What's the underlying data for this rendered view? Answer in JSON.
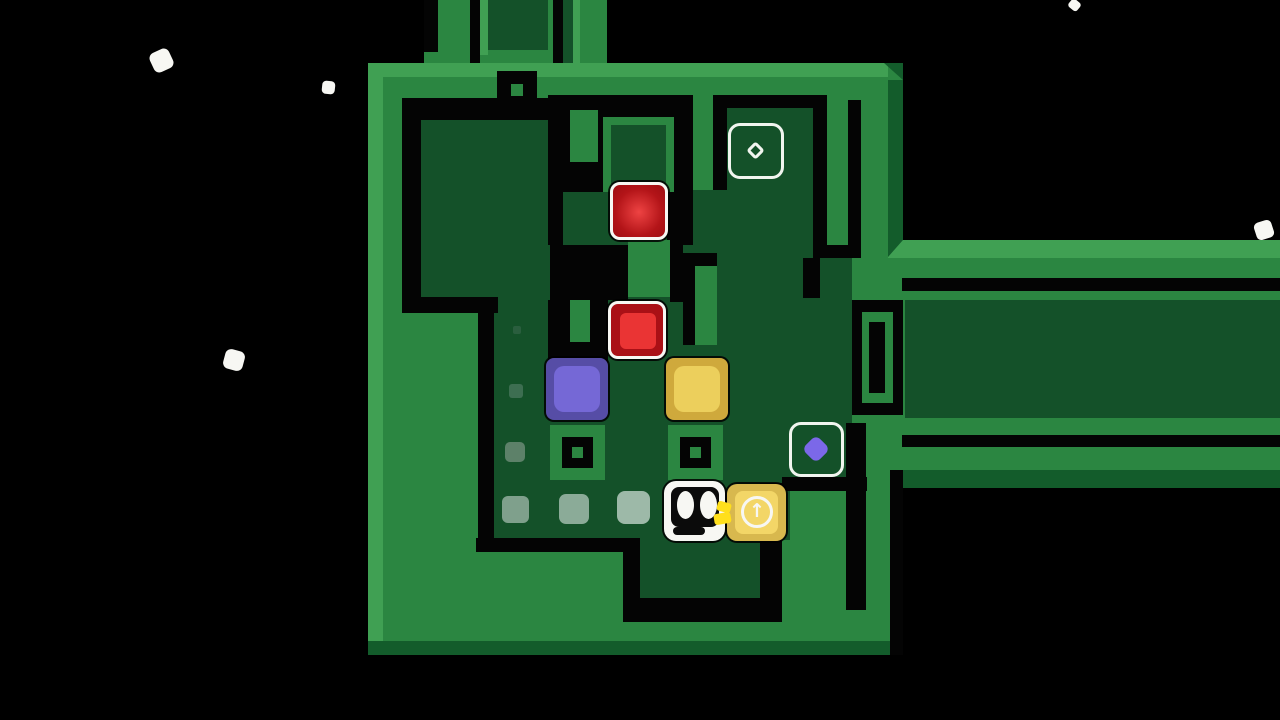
{
  "meta": {
    "scene": "tile-puzzle game level",
    "arrow_glyph": "↑"
  },
  "colors": {
    "black": "#040404",
    "green": "#2b8641",
    "light": "#40a053",
    "dark": "#135c2b",
    "floor": "#145129",
    "white": "#f7f7f3",
    "redOuter": "#aa1016",
    "redInner": "#ea3434",
    "purpleOuter": "#564da6",
    "purpleInner": "#7568d6",
    "yellowOuter": "#cfa93c",
    "yellowInner": "#eccf5c",
    "goldOuter": "#d8b84e",
    "goldInner": "#f3d667",
    "hand": "#ffdf1c",
    "targetStroke": "#f1f5ef",
    "diamondPurple": "#7b68e8",
    "none": "transparent"
  },
  "scene": [
    {
      "n": "star-particle",
      "x": 151,
      "y": 50,
      "w": 21,
      "h": 21,
      "f": "white",
      "r": 6,
      "rot": -25
    },
    {
      "n": "star-particle",
      "x": 322,
      "y": 81,
      "w": 13,
      "h": 13,
      "f": "white",
      "r": 4,
      "rot": 6
    },
    {
      "n": "star-particle",
      "x": 1069,
      "y": 0,
      "w": 11,
      "h": 10,
      "f": "white",
      "r": 3,
      "rot": 40
    },
    {
      "n": "star-particle",
      "x": 1255,
      "y": 221,
      "w": 18,
      "h": 18,
      "f": "white",
      "r": 5,
      "rot": -18
    },
    {
      "n": "star-particle",
      "x": 224,
      "y": 350,
      "w": 20,
      "h": 20,
      "f": "white",
      "r": 6,
      "rot": 15
    },
    {
      "n": "platform-column-left",
      "x": 424,
      "y": 0,
      "w": 46,
      "h": 63,
      "f": "green"
    },
    {
      "n": "wall-groove",
      "x": 424,
      "y": 0,
      "w": 14,
      "h": 52,
      "f": "black"
    },
    {
      "n": "wall-groove",
      "x": 470,
      "y": 0,
      "w": 10,
      "h": 63,
      "f": "black"
    },
    {
      "n": "platform-column-wide",
      "x": 480,
      "y": 0,
      "w": 76,
      "h": 63,
      "f": "green"
    },
    {
      "n": "bevel-light",
      "x": 480,
      "y": 0,
      "w": 8,
      "h": 55,
      "f": "light"
    },
    {
      "n": "floor-inset-top",
      "x": 488,
      "y": 0,
      "w": 60,
      "h": 50,
      "f": "floor"
    },
    {
      "n": "wall-groove",
      "x": 553,
      "y": 0,
      "w": 10,
      "h": 101,
      "f": "black"
    },
    {
      "n": "floor-corridor-top",
      "x": 563,
      "y": 0,
      "w": 10,
      "h": 97,
      "f": "floor"
    },
    {
      "n": "platform-column-mid",
      "x": 573,
      "y": 0,
      "w": 34,
      "h": 63,
      "f": "green"
    },
    {
      "n": "bevel-light",
      "x": 573,
      "y": 0,
      "w": 7,
      "h": 63,
      "f": "light"
    },
    {
      "n": "platform-main",
      "x": 368,
      "y": 63,
      "w": 535,
      "h": 592,
      "f": "green"
    },
    {
      "n": "platform-arm-upper",
      "x": 890,
      "y": 240,
      "w": 390,
      "h": 60,
      "f": "green"
    },
    {
      "n": "platform-arm-lower",
      "x": 890,
      "y": 418,
      "w": 390,
      "h": 52,
      "f": "green"
    },
    {
      "n": "platform-corridor-lip",
      "x": 888,
      "y": 300,
      "w": 18,
      "h": 118,
      "f": "green"
    },
    {
      "n": "bevel-light-top",
      "x": 368,
      "y": 63,
      "w": 520,
      "h": 14,
      "f": "light"
    },
    {
      "n": "bevel-light-left",
      "x": 368,
      "y": 63,
      "w": 15,
      "h": 578,
      "f": "light"
    },
    {
      "n": "bevel-corner",
      "x": 884,
      "y": 63,
      "w": 19,
      "h": 17,
      "f": "dark",
      "clip": "tr"
    },
    {
      "n": "bevel-dark-right",
      "x": 888,
      "y": 80,
      "w": 15,
      "h": 160,
      "f": "dark"
    },
    {
      "n": "bevel-light-arm",
      "x": 888,
      "y": 240,
      "w": 392,
      "h": 18,
      "f": "light"
    },
    {
      "n": "bevel-corner",
      "x": 888,
      "y": 240,
      "w": 15,
      "h": 17,
      "f": "dark",
      "clip": "tl"
    },
    {
      "n": "bevel-dark-bottom",
      "x": 382,
      "y": 641,
      "w": 508,
      "h": 14,
      "f": "dark"
    },
    {
      "n": "bevel-corner",
      "x": 368,
      "y": 641,
      "w": 15,
      "h": 14,
      "f": "dark"
    },
    {
      "n": "bevel-dark-armbottom",
      "x": 897,
      "y": 470,
      "w": 383,
      "h": 18,
      "f": "dark"
    },
    {
      "n": "void-patch",
      "x": 890,
      "y": 470,
      "w": 13,
      "h": 185,
      "f": "black"
    },
    {
      "n": "floor-upper-left",
      "x": 421,
      "y": 120,
      "w": 129,
      "h": 177,
      "f": "floor"
    },
    {
      "n": "floor-red-row",
      "x": 563,
      "y": 192,
      "w": 119,
      "h": 53,
      "f": "floor"
    },
    {
      "n": "floor-central",
      "x": 628,
      "y": 258,
      "w": 162,
      "h": 42,
      "f": "floor"
    },
    {
      "n": "floor-main",
      "x": 490,
      "y": 297,
      "w": 300,
      "h": 243,
      "f": "floor"
    },
    {
      "n": "floor-corridor-mid",
      "x": 682,
      "y": 190,
      "w": 131,
      "h": 110,
      "f": "floor"
    },
    {
      "n": "floor-target-cell",
      "x": 727,
      "y": 107,
      "w": 86,
      "h": 83,
      "f": "floor"
    },
    {
      "n": "floor-right",
      "x": 790,
      "y": 258,
      "w": 62,
      "h": 225,
      "f": "floor"
    },
    {
      "n": "floor-below-player",
      "x": 640,
      "y": 480,
      "w": 120,
      "h": 120,
      "f": "floor"
    },
    {
      "n": "floor-right-corridor",
      "x": 905,
      "y": 300,
      "w": 375,
      "h": 118,
      "f": "floor"
    },
    {
      "n": "wall-groove",
      "x": 402,
      "y": 98,
      "w": 158,
      "h": 22,
      "f": "black"
    },
    {
      "n": "wall-groove",
      "x": 402,
      "y": 98,
      "w": 19,
      "h": 215,
      "f": "black"
    },
    {
      "n": "wall-groove",
      "x": 402,
      "y": 297,
      "w": 96,
      "h": 16,
      "f": "black"
    },
    {
      "n": "wall-groove",
      "x": 478,
      "y": 297,
      "w": 16,
      "h": 255,
      "f": "black"
    },
    {
      "n": "wall-groove",
      "x": 476,
      "y": 538,
      "w": 164,
      "h": 14,
      "f": "black"
    },
    {
      "n": "wall-groove",
      "x": 623,
      "y": 538,
      "w": 17,
      "h": 84,
      "f": "black"
    },
    {
      "n": "wall-groove",
      "x": 640,
      "y": 598,
      "w": 142,
      "h": 24,
      "f": "black"
    },
    {
      "n": "wall-groove",
      "x": 760,
      "y": 483,
      "w": 22,
      "h": 127,
      "f": "black"
    },
    {
      "n": "wall-groove",
      "x": 846,
      "y": 423,
      "w": 20,
      "h": 187,
      "f": "black"
    },
    {
      "n": "wall-band-top",
      "x": 548,
      "y": 95,
      "w": 145,
      "h": 22,
      "f": "black"
    },
    {
      "n": "wall-block",
      "x": 548,
      "y": 117,
      "w": 59,
      "h": 75,
      "f": "black"
    },
    {
      "n": "wall-stub-green",
      "x": 570,
      "y": 110,
      "w": 28,
      "h": 52,
      "f": "green"
    },
    {
      "n": "wall-groove",
      "x": 667,
      "y": 95,
      "w": 26,
      "h": 150,
      "f": "black"
    },
    {
      "n": "wall-groove",
      "x": 713,
      "y": 95,
      "w": 114,
      "h": 13,
      "f": "black"
    },
    {
      "n": "wall-groove",
      "x": 713,
      "y": 95,
      "w": 14,
      "h": 95,
      "f": "black"
    },
    {
      "n": "wall-groove",
      "x": 813,
      "y": 100,
      "w": 14,
      "h": 145,
      "f": "black"
    },
    {
      "n": "wall-groove",
      "x": 848,
      "y": 100,
      "w": 13,
      "h": 158,
      "f": "black"
    },
    {
      "n": "wall-groove",
      "x": 813,
      "y": 245,
      "w": 48,
      "h": 13,
      "f": "black"
    },
    {
      "n": "wall-groove",
      "x": 803,
      "y": 258,
      "w": 17,
      "h": 40,
      "f": "black"
    },
    {
      "n": "wall-groove",
      "x": 548,
      "y": 192,
      "w": 15,
      "h": 53,
      "f": "black"
    },
    {
      "n": "wall-block",
      "x": 550,
      "y": 245,
      "w": 78,
      "h": 55,
      "f": "black"
    },
    {
      "n": "wall-island-green",
      "x": 628,
      "y": 240,
      "w": 42,
      "h": 57,
      "f": "green"
    },
    {
      "n": "wall-groove",
      "x": 670,
      "y": 240,
      "w": 13,
      "h": 62,
      "f": "black"
    },
    {
      "n": "wall-hook-black",
      "x": 683,
      "y": 253,
      "w": 34,
      "h": 92,
      "f": "black"
    },
    {
      "n": "wall-hook-green",
      "x": 695,
      "y": 266,
      "w": 22,
      "h": 79,
      "f": "green"
    },
    {
      "n": "slot-structure-black",
      "x": 548,
      "y": 300,
      "w": 60,
      "h": 63,
      "f": "black"
    },
    {
      "n": "slot-structure-green",
      "x": 570,
      "y": 300,
      "w": 20,
      "h": 42,
      "f": "green"
    },
    {
      "n": "slot-structure-black",
      "x": 852,
      "y": 300,
      "w": 51,
      "h": 115,
      "f": "black"
    },
    {
      "n": "slot-structure-green",
      "x": 862,
      "y": 312,
      "w": 31,
      "h": 91,
      "f": "green"
    },
    {
      "n": "slot-structure-inner",
      "x": 869,
      "y": 322,
      "w": 16,
      "h": 71,
      "f": "black"
    },
    {
      "n": "wall-groove",
      "x": 782,
      "y": 477,
      "w": 85,
      "h": 14,
      "f": "black"
    },
    {
      "n": "wall-groove-arm",
      "x": 902,
      "y": 278,
      "w": 378,
      "h": 13,
      "f": "black"
    },
    {
      "n": "wall-groove-arm",
      "x": 902,
      "y": 435,
      "w": 378,
      "h": 12,
      "f": "black"
    },
    {
      "n": "cell-ring-green",
      "x": 603,
      "y": 117,
      "w": 71,
      "h": 75,
      "f": "green"
    },
    {
      "n": "cell-ring-floor",
      "x": 611,
      "y": 125,
      "w": 55,
      "h": 59,
      "f": "floor"
    },
    {
      "n": "pit-socket",
      "x": 497,
      "y": 71,
      "w": 40,
      "h": 39,
      "f": "black"
    },
    {
      "n": "pit-socket-dot",
      "x": 511,
      "y": 84,
      "w": 12,
      "h": 12,
      "f": "green"
    },
    {
      "n": "pit-socket-rim",
      "x": 550,
      "y": 425,
      "w": 55,
      "h": 55,
      "f": "green"
    },
    {
      "n": "pit-socket",
      "x": 562,
      "y": 437,
      "w": 31,
      "h": 31,
      "f": "black"
    },
    {
      "n": "pit-socket-dot",
      "x": 572,
      "y": 447,
      "w": 11,
      "h": 11,
      "f": "green"
    },
    {
      "n": "pit-socket-rim",
      "x": 668,
      "y": 425,
      "w": 55,
      "h": 55,
      "f": "green"
    },
    {
      "n": "pit-socket",
      "x": 680,
      "y": 437,
      "w": 31,
      "h": 31,
      "f": "black"
    },
    {
      "n": "pit-socket-dot",
      "x": 690,
      "y": 447,
      "w": 11,
      "h": 11,
      "f": "green"
    },
    {
      "n": "movement-trail",
      "x": 513,
      "y": 326,
      "w": 8,
      "h": 8,
      "f": "#2a5e3e",
      "r": 2
    },
    {
      "n": "movement-trail",
      "x": 509,
      "y": 384,
      "w": 14,
      "h": 14,
      "f": "#3d6e51",
      "r": 3
    },
    {
      "n": "movement-trail",
      "x": 505,
      "y": 442,
      "w": 20,
      "h": 20,
      "f": "#5d8169",
      "r": 5
    },
    {
      "n": "movement-trail",
      "x": 502,
      "y": 496,
      "w": 27,
      "h": 27,
      "f": "#7fa08c",
      "r": 6
    },
    {
      "n": "movement-trail",
      "x": 559,
      "y": 494,
      "w": 30,
      "h": 30,
      "f": "#8bab98",
      "r": 7
    },
    {
      "n": "movement-trail",
      "x": 617,
      "y": 491,
      "w": 33,
      "h": 33,
      "f": "#9db9a8",
      "r": 8
    },
    {
      "n": "red-block-glow",
      "x": 610,
      "y": 182,
      "w": 58,
      "h": 58,
      "f": "none",
      "r": 10,
      "bw": 3,
      "bc": "white",
      "sh": 1,
      "int": "true",
      "grad": "radial-gradient(circle at 50% 52%, #ee4343 0%, #b31418 62%, #9c0e12 100%)"
    },
    {
      "n": "red-block",
      "x": 608,
      "y": 301,
      "w": 58,
      "h": 58,
      "f": "redOuter",
      "r": 10,
      "bw": 3,
      "bc": "white",
      "sh": 1,
      "int": "true"
    },
    {
      "n": "red-block-inner",
      "x": 620,
      "y": 313,
      "w": 36,
      "h": 36,
      "f": "redInner",
      "r": 6
    },
    {
      "n": "purple-block",
      "x": 546,
      "y": 358,
      "w": 62,
      "h": 62,
      "f": "purpleOuter",
      "r": 8,
      "sh": 1,
      "int": "true"
    },
    {
      "n": "purple-block-inner",
      "x": 554,
      "y": 366,
      "w": 46,
      "h": 46,
      "f": "purpleInner",
      "r": 10
    },
    {
      "n": "yellow-block",
      "x": 666,
      "y": 358,
      "w": 62,
      "h": 62,
      "f": "yellowOuter",
      "r": 8,
      "sh": 1,
      "int": "true"
    },
    {
      "n": "yellow-block-inner",
      "x": 674,
      "y": 366,
      "w": 46,
      "h": 46,
      "f": "yellowInner",
      "r": 10
    },
    {
      "n": "goal-outline-empty",
      "x": 728,
      "y": 123,
      "w": 56,
      "h": 56,
      "f": "none",
      "r": 12,
      "bw": 3,
      "bc": "targetStroke"
    },
    {
      "n": "goal-diamond-outline",
      "x": 749,
      "y": 144,
      "w": 13,
      "h": 13,
      "f": "none",
      "r": 3,
      "bw": 3,
      "bc": "targetStroke",
      "rot": 45
    },
    {
      "n": "goal-outline-purple",
      "x": 789,
      "y": 422,
      "w": 55,
      "h": 55,
      "f": "none",
      "r": 12,
      "bw": 3,
      "bc": "targetStroke"
    },
    {
      "n": "goal-diamond-purple",
      "x": 806,
      "y": 439,
      "w": 20,
      "h": 20,
      "f": "diamondPurple",
      "r": 6,
      "rot": 45
    },
    {
      "n": "player-character",
      "x": 664,
      "y": 481,
      "w": 61,
      "h": 60,
      "f": "white",
      "r": 12,
      "sh": 1,
      "int": "true"
    },
    {
      "n": "player-face",
      "x": 671,
      "y": 487,
      "w": 48,
      "h": 40,
      "f": "#0b0b0b",
      "r": 8
    },
    {
      "n": "player-eye",
      "x": 677,
      "y": 491,
      "w": 17,
      "h": 28,
      "f": "white",
      "r": "50%"
    },
    {
      "n": "player-eye",
      "x": 700,
      "y": 491,
      "w": 17,
      "h": 28,
      "f": "white",
      "r": "50%"
    },
    {
      "n": "player-mouth",
      "x": 673,
      "y": 527,
      "w": 32,
      "h": 8,
      "f": "#0b0b0b",
      "r": 4
    },
    {
      "n": "arrow-block",
      "x": 727,
      "y": 484,
      "w": 59,
      "h": 57,
      "f": "goldOuter",
      "r": 10,
      "sh": 1,
      "int": "true"
    },
    {
      "n": "arrow-block-inner",
      "x": 735,
      "y": 491,
      "w": 43,
      "h": 43,
      "f": "goldInner",
      "r": 8
    },
    {
      "n": "arrow-block-circle",
      "x": 741,
      "y": 496,
      "w": 32,
      "h": 32,
      "f": "none",
      "r": "50%",
      "bw": 3,
      "bc": "white"
    },
    {
      "n": "arrow-block-arrow-icon",
      "x": 741,
      "y": 495,
      "w": 32,
      "h": 32,
      "f": "none",
      "text": "arrow_glyph",
      "fs": 19
    },
    {
      "n": "player-hand",
      "x": 717,
      "y": 502,
      "w": 14,
      "h": 10,
      "f": "hand",
      "r": 3,
      "rot": 15
    },
    {
      "n": "player-hand",
      "x": 714,
      "y": 513,
      "w": 17,
      "h": 11,
      "f": "hand",
      "r": 3,
      "rot": -10
    }
  ]
}
